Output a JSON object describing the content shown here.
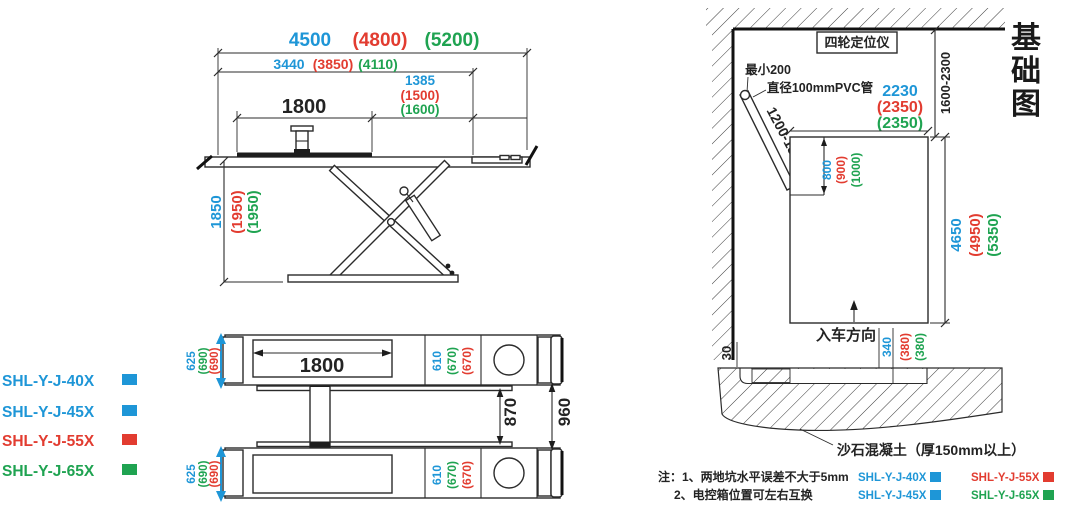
{
  "colors": {
    "blue": "#1E96D7",
    "red": "#E23C30",
    "green": "#1FA351",
    "line": "#232323"
  },
  "models": {
    "m40": "SHL-Y-J-40X",
    "m45": "SHL-Y-J-45X",
    "m55": "SHL-Y-J-55X",
    "m65": "SHL-Y-J-65X"
  },
  "side_view": {
    "len_total": [
      "4500",
      "(4800)",
      "(5200)"
    ],
    "len_frame": [
      "3440",
      "(3850)",
      "(4110)"
    ],
    "len_rear": [
      "1385",
      "(1500)",
      "(1600)"
    ],
    "len_tread": "1800",
    "height": [
      "1850",
      "(1950)",
      "(1950)"
    ]
  },
  "plan_view": {
    "tread_len": "1800",
    "platform_width": [
      "625",
      "(690)",
      "(690)"
    ],
    "tread_width": [
      "610",
      "(670)",
      "(670)"
    ],
    "gap_inner": "870",
    "gap_outer": "960"
  },
  "foundation": {
    "title": "基础图",
    "aligner": "四轮定位仪",
    "min_clearance": "最小200",
    "pipe": "直径100mmPVC管",
    "pipe_range": "1200-1800",
    "wall_to_pit": "1600-2300",
    "pit_width": [
      "2230",
      "(2350)",
      "(2350)"
    ],
    "recess_len": [
      "800",
      "(900)",
      "(1000)"
    ],
    "pit_len": [
      "4650",
      "(4950)",
      "(5350)"
    ],
    "entry": "入车方向",
    "edge_gap": "30",
    "pit_depth": [
      "340",
      "(380)",
      "(380)"
    ],
    "concrete": "沙石混凝土（厚150mm以上）",
    "note1": "注：1、两地坑水平误差不大于5mm",
    "note2": "2、电控箱位置可左右互换"
  }
}
